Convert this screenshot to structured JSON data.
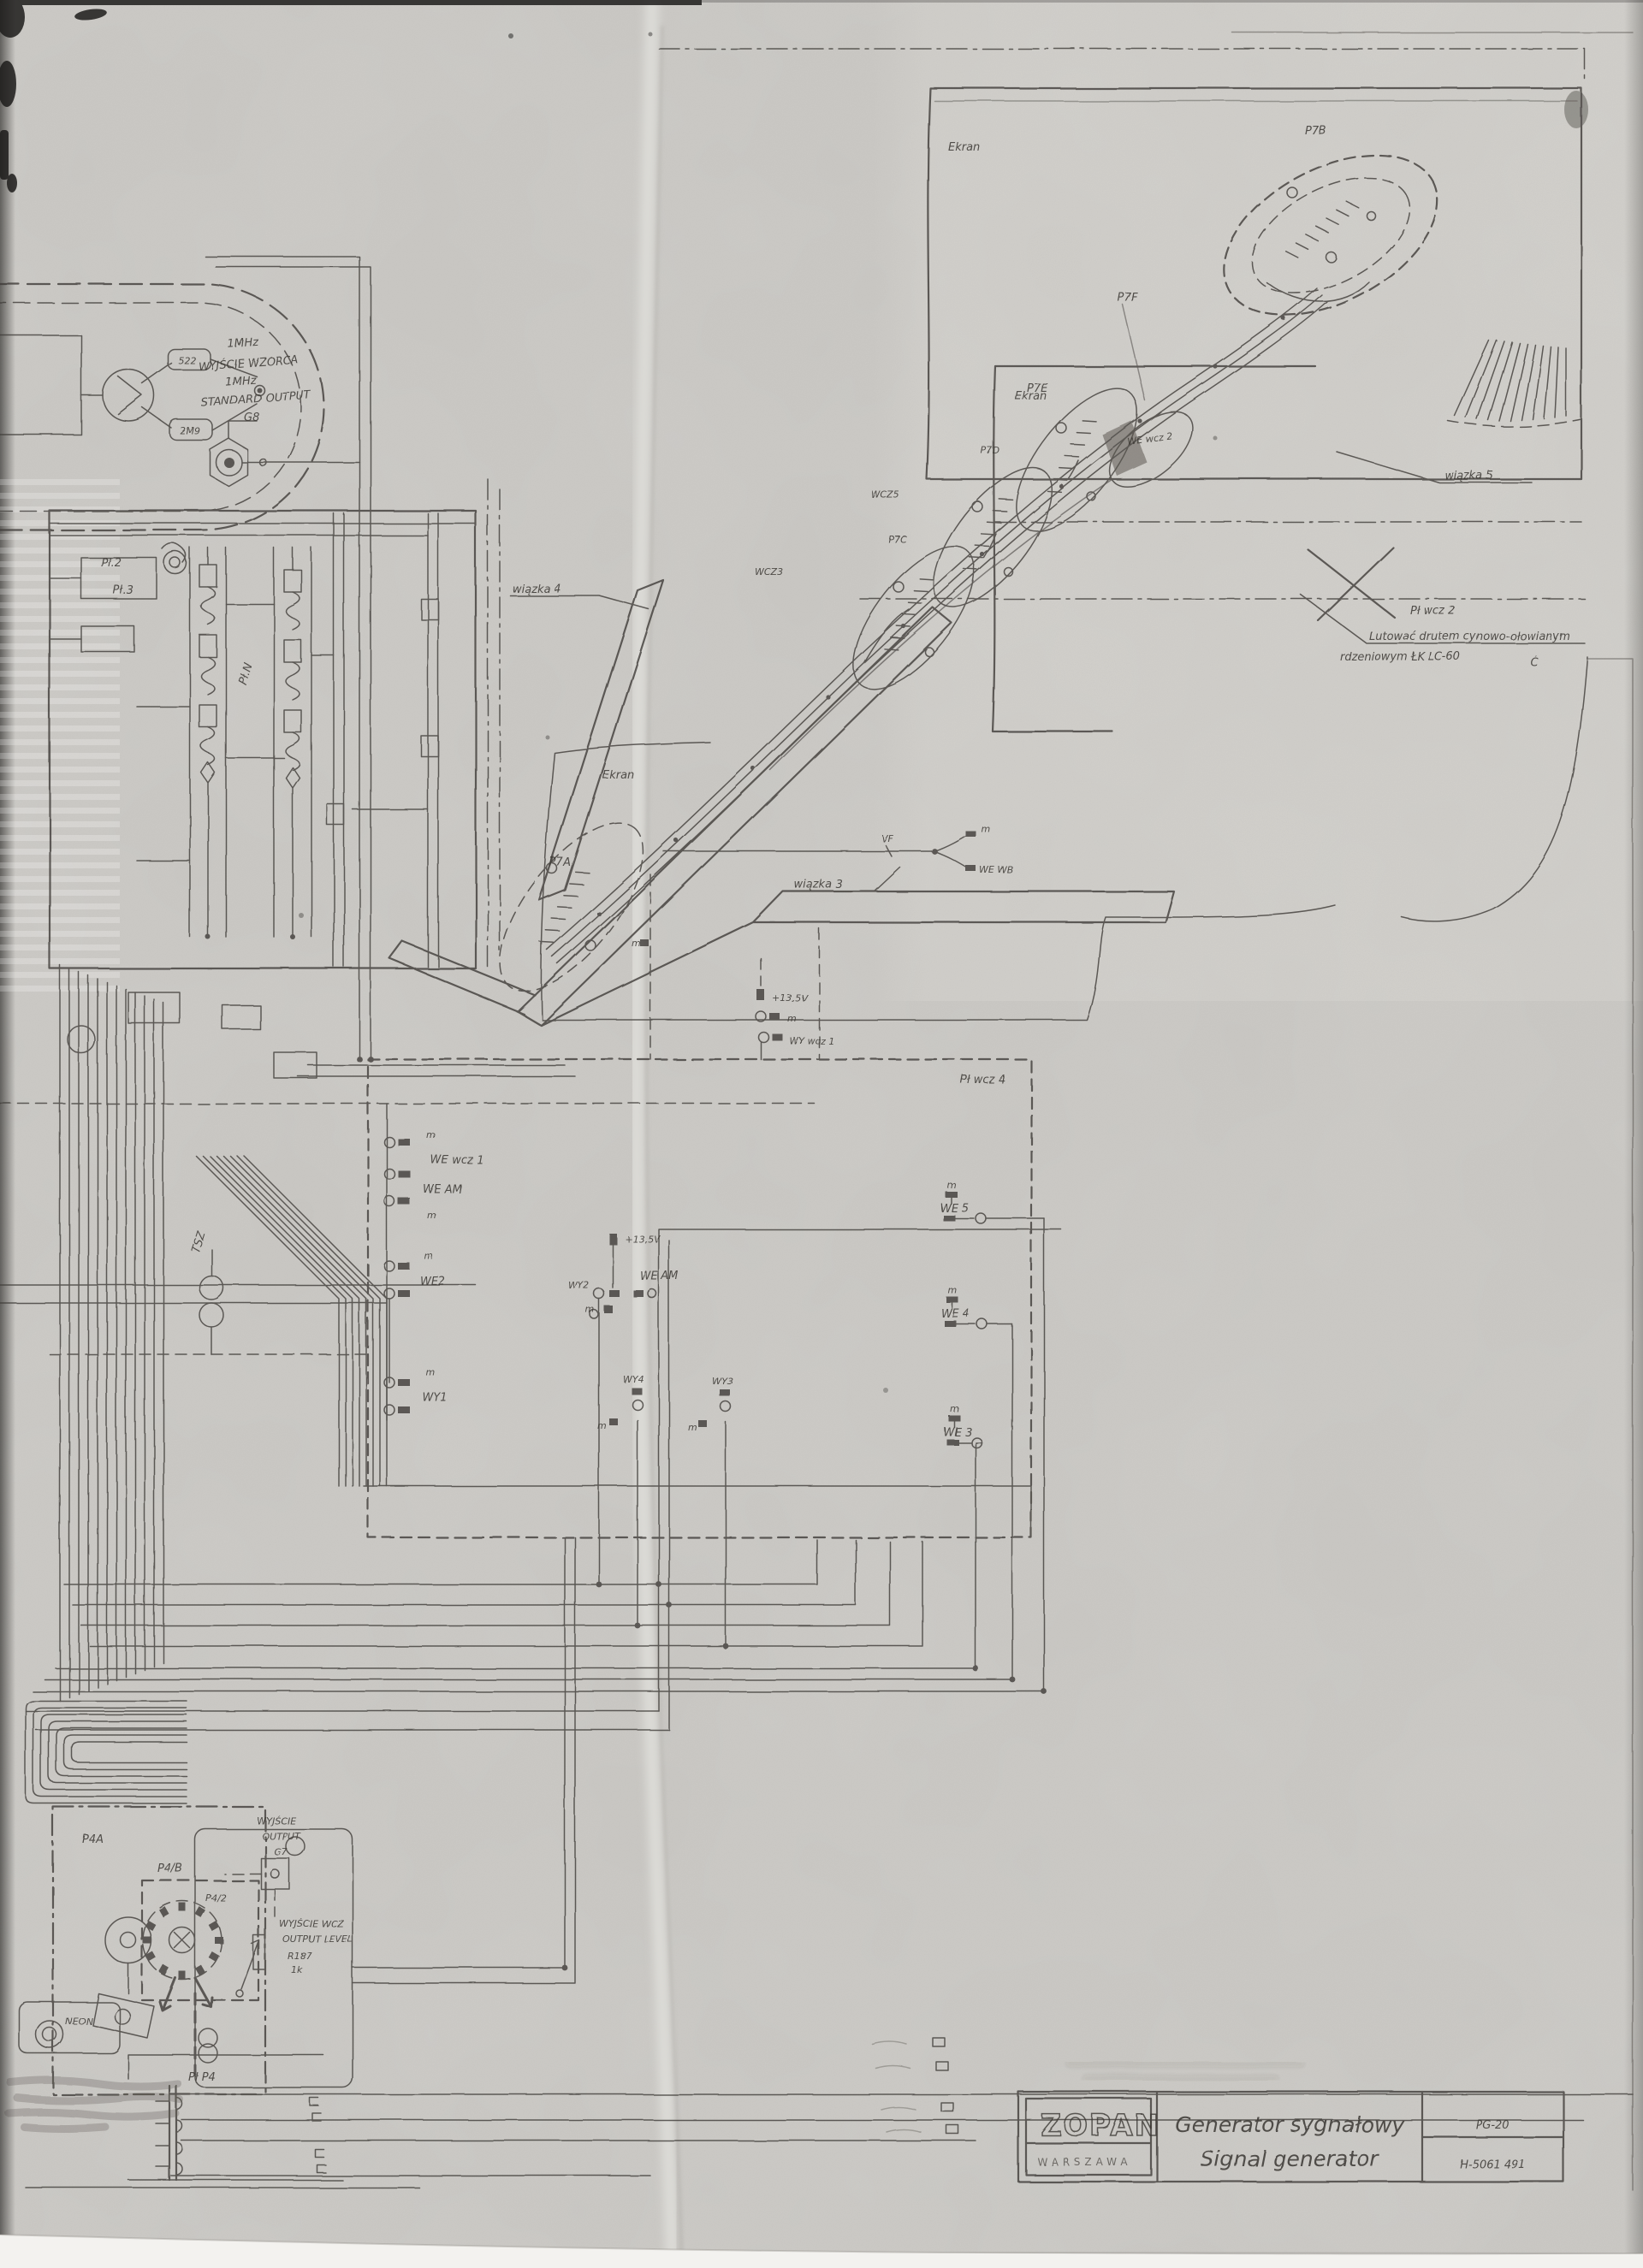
{
  "colors": {
    "paper": "#c9c7c3",
    "paper_fold": "#d8d6d2",
    "ink": "#3b3833"
  },
  "title_block": {
    "company": "ZOPAN",
    "city": "WARSZAWA",
    "title_pl": "Generator sygnałowy",
    "title_en": "Signal generator",
    "model": "PG-20",
    "doc_no": "H-5061 491"
  },
  "oscillator": {
    "freq_top": "1MHz",
    "line1": "WYJŚCIE WZORCA",
    "freq_mid": "1MHz",
    "line2": "STANDARD OUTPUT",
    "connector": "G8",
    "part_a": "522",
    "part_b": "2M9"
  },
  "iso": {
    "ekran": "Ekran",
    "p7a": "P7A",
    "p7b": "P7B",
    "p7c": "P7C",
    "p7d": "P7D",
    "p7e": "P7E",
    "p7f": "P7F",
    "wiazka3": "wiązka 3",
    "wiazka4": "wiązka 4",
    "wiazka5": "wiązka 5",
    "pl_wcz2": "Pł wcz 2",
    "we_wcz2": "WE wcz 2",
    "wcz5": "WCZ5",
    "wcz3": "WCZ3",
    "we_wb": "WE WB",
    "vf": "VF",
    "check": "Ć",
    "note1": "Lutować drutem cynowo-ołowianym",
    "note2": "rdzeniowym ŁK LC-60"
  },
  "wcz4": {
    "label": "Pł wcz 4",
    "we_wcz1": "WE wcz 1",
    "wy_wcz1": "WY wcz 1",
    "we_am": "WE AM",
    "we2": "WE2",
    "we3": "WE 3",
    "we4": "WE 4",
    "we5": "WE 5",
    "wy1": "WY1",
    "wy2": "WY2",
    "wy3": "WY3",
    "wy4": "WY4",
    "v135": "+13,5V"
  },
  "left": {
    "pl2": "Pł.2",
    "pl3": "Pł.3",
    "pln": "Pł.N",
    "tsz": "TSZ"
  },
  "module": {
    "p4a": "P4A",
    "p4b": "P4/B",
    "p42": "P4/2",
    "neon": "NEON",
    "out_pl": "WYJŚCIE",
    "out_en": "OUTPUT",
    "g7": "G7",
    "lvl_pl": "WYJŚCIE WCZ",
    "lvl_en": "OUTPUT LEVEL",
    "r187": "R187",
    "r187_val": "1k",
    "pl_p4": "Pł P4"
  },
  "common": {
    "m": "m"
  }
}
